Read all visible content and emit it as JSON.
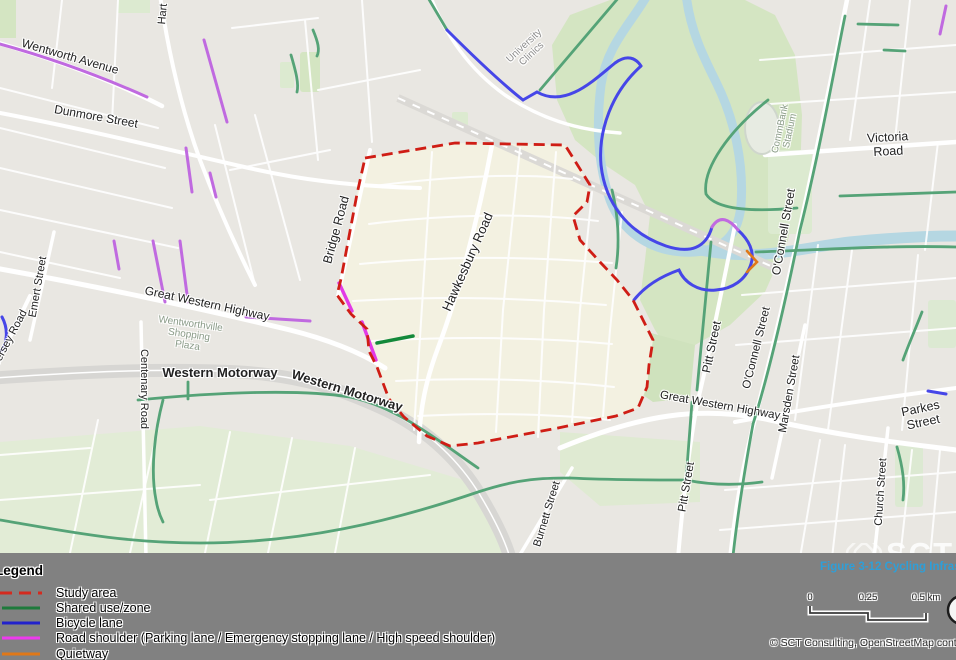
{
  "logo": {
    "brand": "SCT",
    "tagline": "Consulting"
  },
  "map": {
    "labels": [
      {
        "text": "Wentworth Avenue"
      },
      {
        "text": "Dunmore Street"
      },
      {
        "text": "Hart"
      },
      {
        "text": "Emert Street"
      },
      {
        "text": "Jersey Road"
      },
      {
        "text": "Great Western Highway"
      },
      {
        "text": "Centenary Road"
      },
      {
        "text": "Western Motorway"
      },
      {
        "text": "Western Motorway"
      },
      {
        "text": "Bridge Road"
      },
      {
        "text": "Hawkesbury Road"
      },
      {
        "text": "Victoria Road"
      },
      {
        "text": "O'Connell Street"
      },
      {
        "text": "O'Connell Street"
      },
      {
        "text": "Pitt Street"
      },
      {
        "text": "Pitt Street"
      },
      {
        "text": "Marsden Street"
      },
      {
        "text": "Great Western Highway"
      },
      {
        "text": "Parkes Street"
      },
      {
        "text": "Church Street"
      },
      {
        "text": "Burnett Street"
      },
      {
        "text": "University\nClinics"
      },
      {
        "text": "CommBank\nStadium"
      },
      {
        "text": "Wentworthville\nShopping\nPlaza"
      }
    ]
  },
  "legend": {
    "title": "Legend",
    "items": [
      {
        "label": "Study area",
        "color": "#d42a1e",
        "style": "dashed"
      },
      {
        "label": "Shared use/zone",
        "color": "#1e7a3c",
        "style": "solid"
      },
      {
        "label": "Bicycle lane",
        "color": "#2222cc",
        "style": "solid"
      },
      {
        "label": "Road shoulder (Parking lane / Emergency stopping lane / High speed shoulder)",
        "color": "#ee3aee",
        "style": "solid"
      },
      {
        "label": "Quietway",
        "color": "#e07818",
        "style": "solid"
      }
    ]
  },
  "caption": "Figure 3-12 Cycling Infrastructure",
  "scalebar": {
    "t0": "0",
    "t1": "0.25",
    "t2": "0.5 km"
  },
  "attribution": "© SCT Consulting, OpenStreetMap contributors",
  "colors": {
    "study_boundary": "#cf1d15",
    "study_fill": "#f3f1e1",
    "shared_use": "#55a377",
    "bicycle_lane": "#4646e8",
    "road_shoulder": "#c06ae0",
    "road_shoulder_bright": "#e23ae6",
    "quietway": "#e07818",
    "river": "#b5d7e2",
    "park": "#d4e5c2",
    "footer_bg": "#818181",
    "caption_blue": "#2e9fd8"
  }
}
